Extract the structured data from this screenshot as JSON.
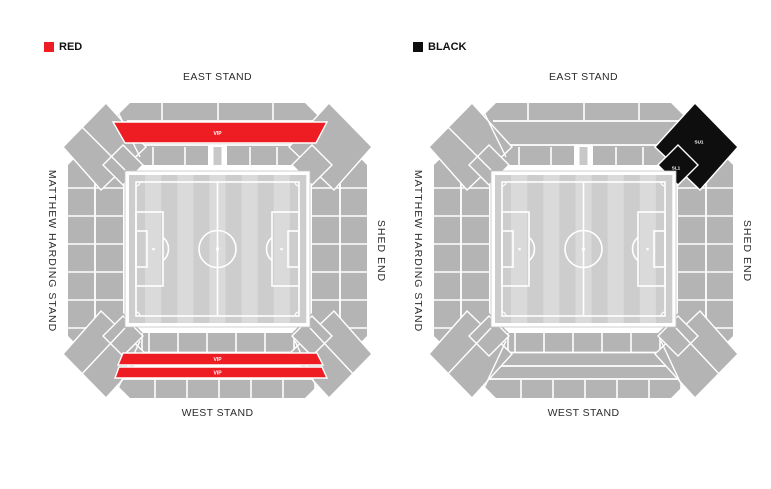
{
  "legend": {
    "red": {
      "label": "RED",
      "color": "#ee1c23"
    },
    "black": {
      "label": "BLACK",
      "color": "#0e0e0e"
    }
  },
  "maps": [
    {
      "key": "red",
      "stands": {
        "north": "EAST STAND",
        "south": "WEST STAND",
        "west": "MATTHEW HARDING STAND",
        "east": "SHED END"
      },
      "highlight_color": "#ee1c23",
      "highlight_label_color": "#ffffff",
      "highlights": [
        {
          "section": "east-upper-vip",
          "label": "VIP"
        },
        {
          "section": "west-upper-vip-row1",
          "label": "VIP"
        },
        {
          "section": "west-upper-vip-row2",
          "label": "VIP"
        }
      ]
    },
    {
      "key": "black",
      "stands": {
        "north": "EAST STAND",
        "south": "WEST STAND",
        "west": "MATTHEW HARDING STAND",
        "east": "SHED END"
      },
      "highlight_color": "#0e0e0e",
      "highlight_label_color": "#ffffff",
      "highlights": [
        {
          "section": "shed-end-corner-upper",
          "label": "SU1"
        },
        {
          "section": "shed-end-corner-lower",
          "label": "SL1"
        }
      ]
    }
  ],
  "colors": {
    "stand_gray": "#b4b4b4",
    "section_line": "#ffffff",
    "pitch_stripe_dark": "#cdcdcd",
    "pitch_stripe_light": "#dadada",
    "pitch_line": "#ffffff",
    "background": "#ffffff"
  }
}
